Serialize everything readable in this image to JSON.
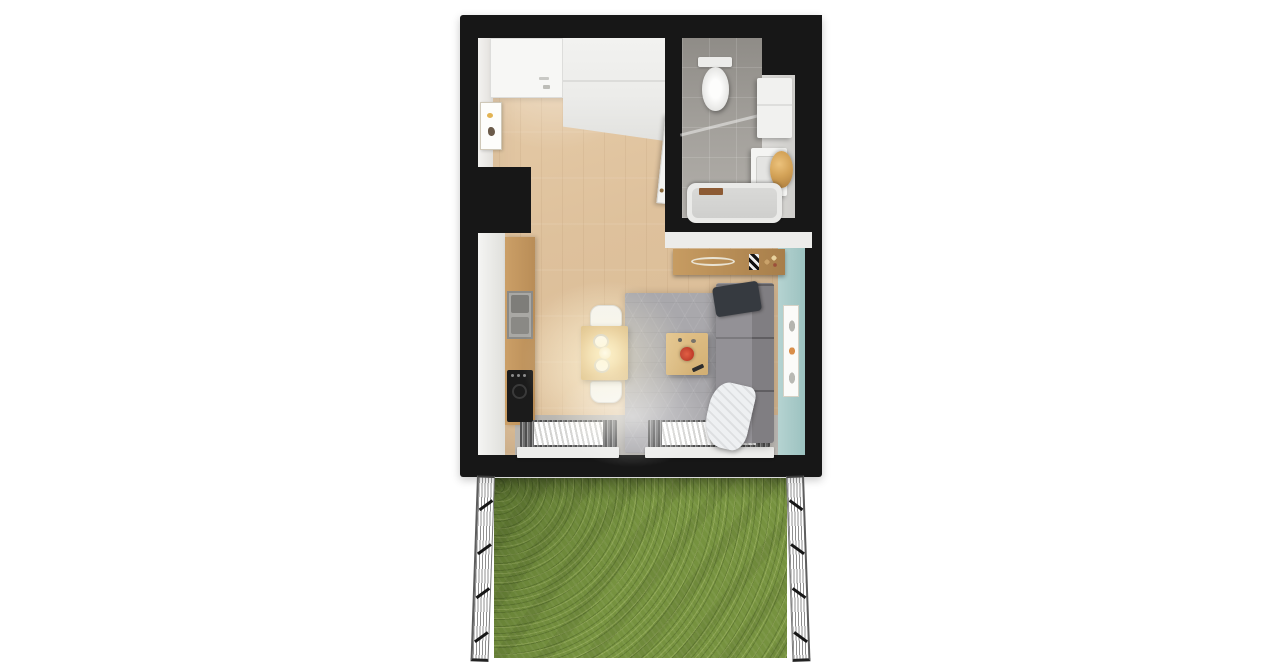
{
  "image": {
    "kind": "3D top-down floor plan render",
    "background": "#ffffff",
    "contains_text": false
  },
  "labels": {
    "apartment": "studio apartment floor plan (top-down 3D render)",
    "entry": "entry with flat-lying entrance door and white wardrobe",
    "wall_art_left": "small framed picture on left wall",
    "kitchen": "kitchenette: white cabinets, wood counter, steel sink, black stove",
    "dining": "wood dining table with two white chairs, two plates and pendant light glow",
    "rug": "grey patterned rug",
    "coffee_table": "wood coffee table with red bowl and remote",
    "sofa": "grey sofa along teal wall with dark pillow and white blanket",
    "console": "wood console sideboard with dish, chevron decor and bottles",
    "radiators": "two white radiators on window sill platform",
    "bathroom": "bathroom: grey tiled shower floor, toilet, washer cabinet, vanity sink with round gold mirror, bathtub",
    "teal_wall": "teal accent wall with framed botanical print",
    "garden": "private garden with grass lawn",
    "fence_left": "left wire fence",
    "fence_right": "right wire fence"
  },
  "colors": {
    "walls": "#171717",
    "wood_floor": "#dec19c",
    "bathroom_tile": "#a5a29d",
    "rug_grey": "#a9a8ac",
    "sofa_grey": "#939196",
    "accent_teal": "#a8cbc9",
    "grass_green": "#76923f",
    "counter_wood": "#c0945e",
    "mirror_gold": "#d3a257",
    "bowl_red": "#c0392b",
    "furniture_white": "#f1f1ef"
  }
}
